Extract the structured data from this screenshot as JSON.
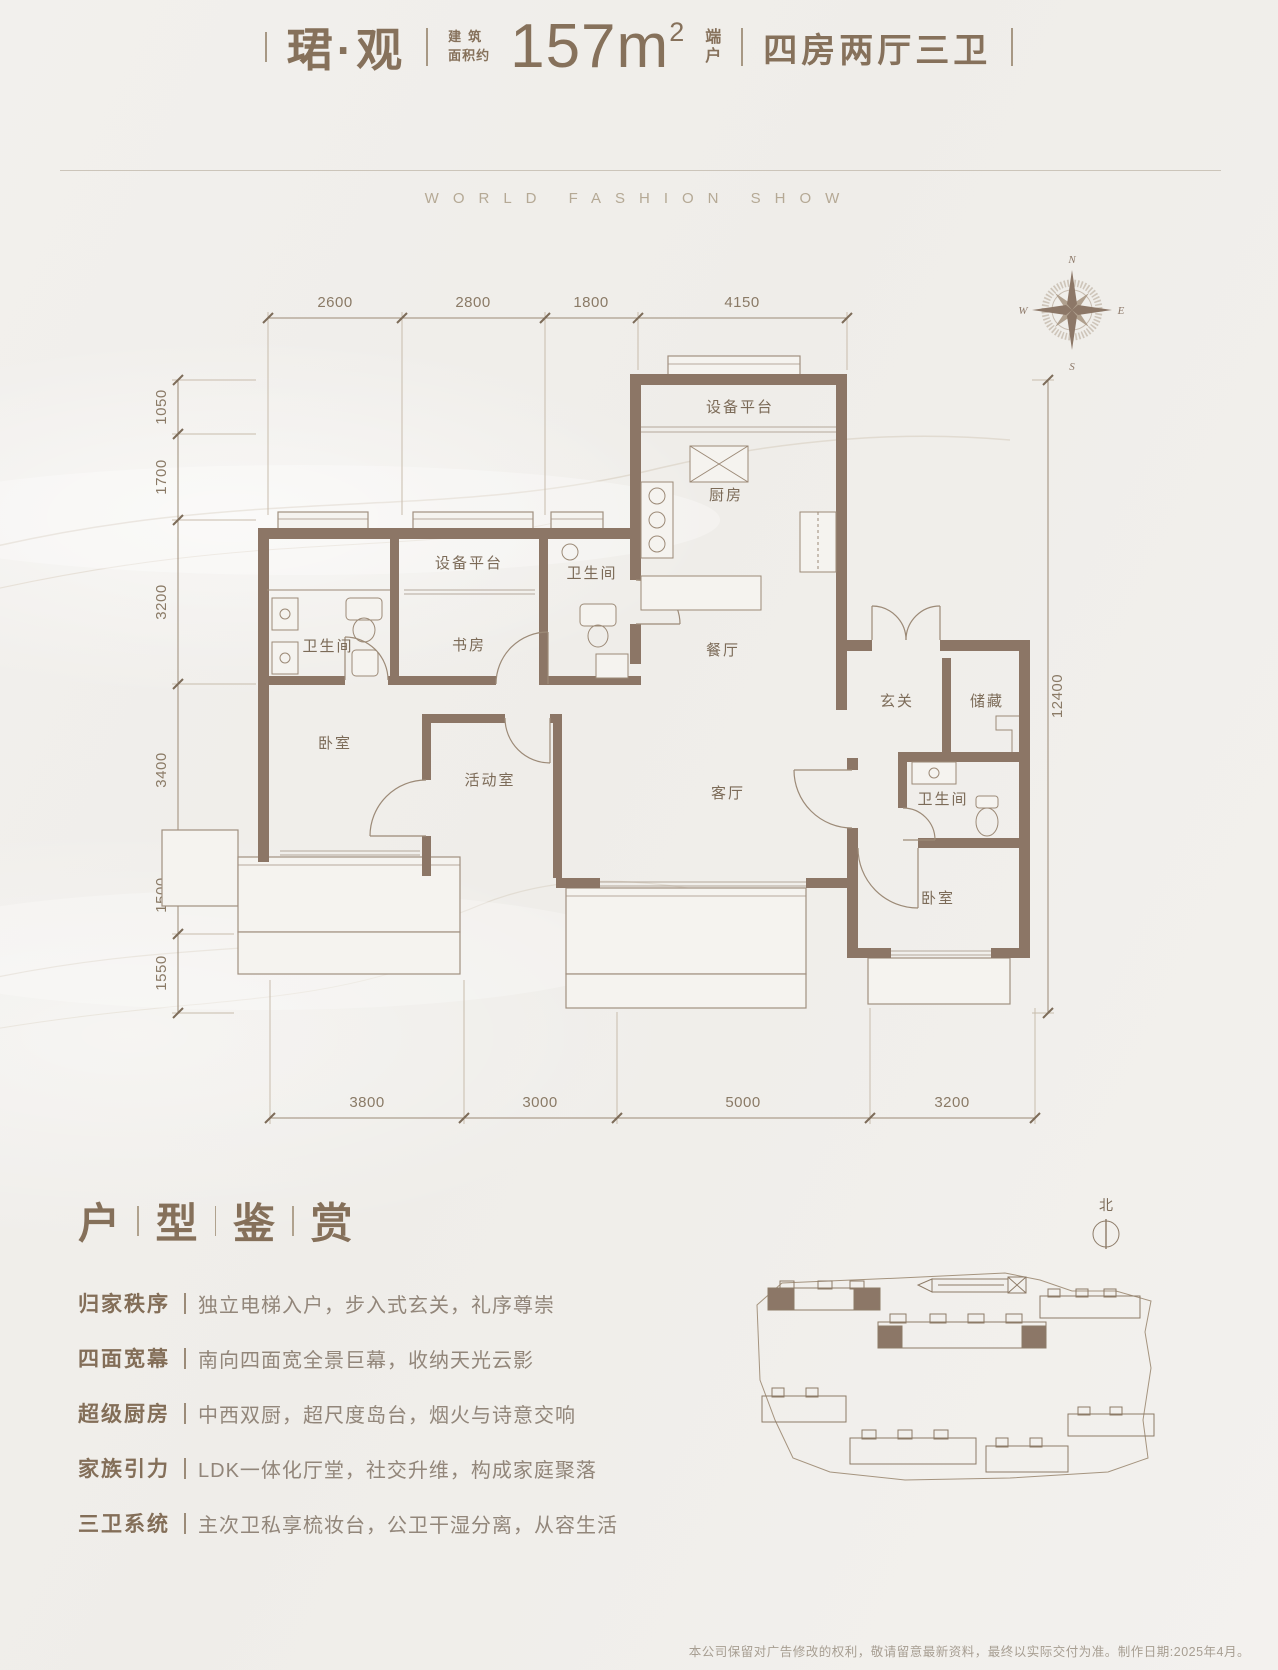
{
  "header": {
    "name": "珺·观",
    "area_prefix_line1": "建筑",
    "area_prefix_line2": "面积约",
    "area_value": "157m",
    "area_sup": "2",
    "unit_tag_line1": "端",
    "unit_tag_line2": "户",
    "layout": "四房两厅三卫"
  },
  "subtitle": "WORLD FASHION SHOW",
  "compass": {
    "n": "N",
    "e": "E",
    "s": "S",
    "w": "W"
  },
  "floor_plan": {
    "dims_top": [
      "2600",
      "2800",
      "1800",
      "4150"
    ],
    "dims_left": [
      "1050",
      "1700",
      "3200",
      "3400",
      "1500",
      "1550"
    ],
    "dims_right": [
      "12400"
    ],
    "dims_bottom": [
      "3800",
      "3000",
      "5000",
      "3200"
    ],
    "rooms": {
      "equip_top": "设备平台",
      "kitchen": "厨房",
      "bath_master": "卫生间",
      "equip_mid": "设备平台",
      "bath_small": "卫生间",
      "study": "书房",
      "dining": "餐厅",
      "foyer": "玄关",
      "storage": "储藏",
      "bedroom_left": "卧室",
      "activity": "活动室",
      "living": "客厅",
      "bath_right": "卫生间",
      "bedroom_right": "卧室"
    }
  },
  "section": {
    "title_chars": [
      "户",
      "型",
      "鉴",
      "赏"
    ],
    "features": [
      {
        "label": "归家秩序",
        "desc": "独立电梯入户，步入式玄关，礼序尊崇"
      },
      {
        "label": "四面宽幕",
        "desc": "南向四面宽全景巨幕，收纳天光云影"
      },
      {
        "label": "超级厨房",
        "desc": "中西双厨，超尺度岛台，烟火与诗意交响"
      },
      {
        "label": "家族引力",
        "desc": "LDK一体化厅堂，社交升维，构成家庭聚落"
      },
      {
        "label": "三卫系统",
        "desc": "主次卫私享梳妆台，公卫干湿分离，从容生活"
      }
    ]
  },
  "site_plan": {
    "north_label": "北"
  },
  "footer": {
    "disclaimer": "本公司保留对广告修改的权利，敬请留意最新资料，最终以实际交付为准。制作日期:2025年4月。"
  }
}
